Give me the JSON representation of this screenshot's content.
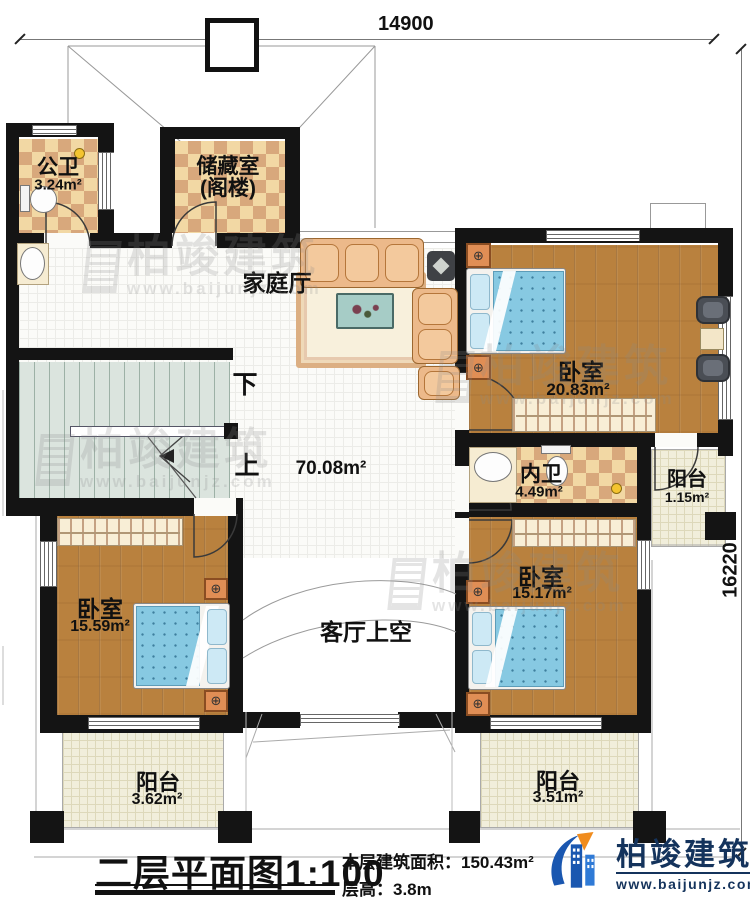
{
  "plan": {
    "dim_top": "14900",
    "dim_right": "16220",
    "rooms": {
      "public_bath": {
        "name": "公卫",
        "area": "3.24m²"
      },
      "storage": {
        "name": "储藏室",
        "name2": "(阁楼)"
      },
      "family_hall": {
        "name": "家庭厅"
      },
      "hall_area": "70.08m²",
      "bedroom_tr": {
        "name": "卧室",
        "area": "20.83m²"
      },
      "inner_bath": {
        "name": "内卫",
        "area": "4.49m²"
      },
      "balcony_right": {
        "name": "阳台",
        "area": "1.15m²"
      },
      "bedroom_bl": {
        "name": "卧室",
        "area": "15.59m²"
      },
      "bedroom_br": {
        "name": "卧室",
        "area": "15.17m²"
      },
      "void": {
        "name": "客厅上空"
      },
      "balcony_bl": {
        "name": "阳台",
        "area": "3.62m²"
      },
      "balcony_br": {
        "name": "阳台",
        "area": "3.51m²"
      }
    },
    "stairs": {
      "down": "下",
      "up": "上"
    }
  },
  "titleblock": {
    "title": "二层平面图",
    "scale": "1:100",
    "area_label": "本层建筑面积：",
    "area_value": "150.43m²",
    "height_label": "层高：",
    "height_value": "3.8m"
  },
  "brand": {
    "name": "柏竣建筑",
    "website": "www.baijunjz.com"
  },
  "watermark": {
    "name": "柏竣建筑",
    "website": "www.baijunjz.com"
  },
  "colors": {
    "wall": "#141414",
    "wood_floor": "#b9813e",
    "tile_light": "#f2d8a4",
    "tile_dark": "#d8a87c",
    "bed_blue": "#87c9e2",
    "nightstand_orange": "#e08e55",
    "stair_green": "#dbe4de",
    "brand_blue": "#14335c",
    "brand_orange": "#f08c1e"
  }
}
